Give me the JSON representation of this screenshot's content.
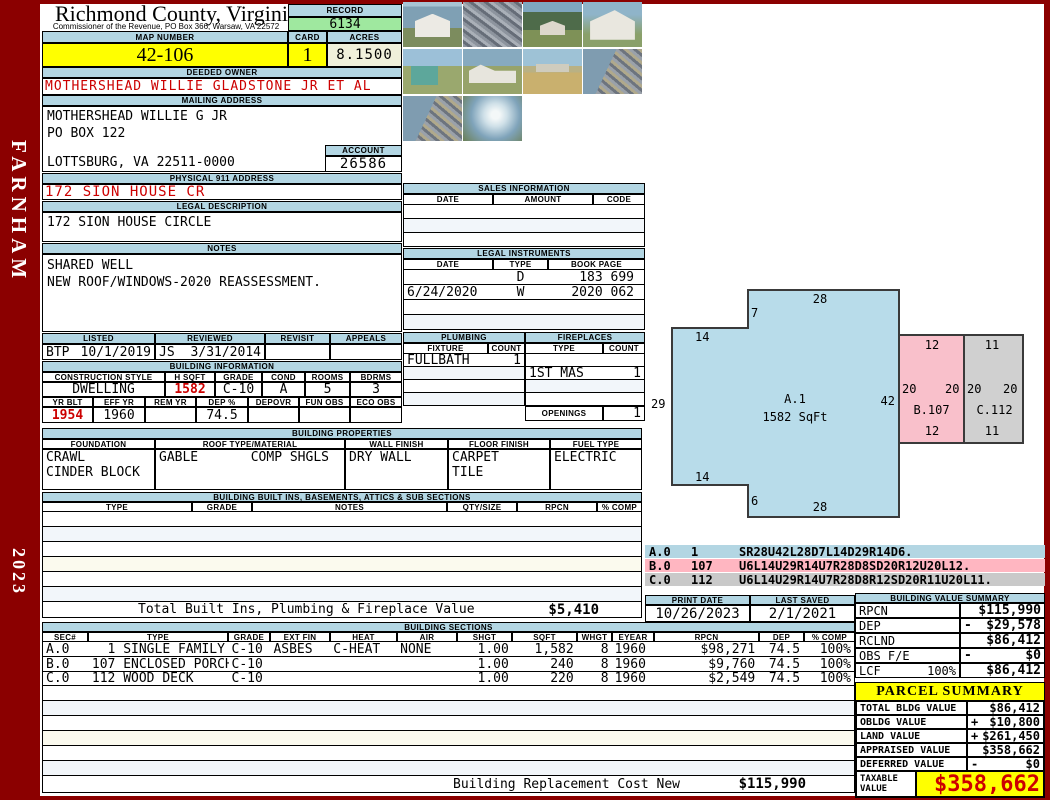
{
  "frame": {
    "district": "FARNHAM",
    "year": "2023"
  },
  "header": {
    "county": "Richmond County, Virginia",
    "subtitle": "Commissioner of the Revenue, PO Box 366, Warsaw, VA 22572",
    "record_label": "RECORD",
    "record": "6134",
    "map_number_label": "MAP NUMBER",
    "map_number": "42-106",
    "card_label": "CARD",
    "card": "1",
    "acres_label": "ACRES",
    "acres": "8.1500"
  },
  "owner": {
    "deeded_owner_label": "DEEDED OWNER",
    "deeded_owner": "MOTHERSHEAD WILLIE GLADSTONE JR ET AL",
    "mailing_address_label": "MAILING ADDRESS",
    "mailing_line1": "MOTHERSHEAD WILLIE G JR",
    "mailing_line2": "PO BOX 122",
    "mailing_line3": "LOTTSBURG, VA 22511-0000",
    "account_label": "ACCOUNT",
    "account": "26586",
    "physical_address_label": "PHYSICAL 911 ADDRESS",
    "physical_address": "172 SION HOUSE CR",
    "legal_description_label": "LEGAL DESCRIPTION",
    "legal_description": "172 SION HOUSE CIRCLE",
    "notes_label": "NOTES",
    "notes_line1": "SHARED WELL",
    "notes_line2": "NEW ROOF/WINDOWS-2020 REASSESSMENT."
  },
  "review": {
    "listed_label": "LISTED",
    "reviewed_label": "REVIEWED",
    "revisit_label": "REVISIT",
    "appeals_label": "APPEALS",
    "listed_by": "BTP",
    "listed_date": "10/1/2019",
    "reviewed_by": "JS",
    "reviewed_date": "3/31/2014",
    "revisit": "",
    "appeals": ""
  },
  "building_information": {
    "title": "BUILDING INFORMATION",
    "construction_style_label": "CONSTRUCTION STYLE",
    "construction_style": "DWELLING",
    "hsqft_label": "H SQFT",
    "hsqft": "1582",
    "grade_label": "GRADE",
    "grade": "C-10",
    "cond_label": "COND",
    "cond": "A",
    "rooms_label": "ROOMS",
    "rooms": "5",
    "bdrms_label": "BDRMS",
    "bdrms": "3",
    "yr_blt_label": "YR BLT",
    "yr_blt": "1954",
    "eff_yr_label": "EFF YR",
    "eff_yr": "1960",
    "rem_yr_label": "REM YR",
    "rem_yr": "",
    "dep_label": "DEP %",
    "dep": "74.5",
    "depovr_label": "DEPOVR",
    "depovr": "",
    "fun_obs_label": "FUN OBS",
    "fun_obs": "",
    "eco_obs_label": "ECO OBS",
    "eco_obs": ""
  },
  "building_properties": {
    "title": "BUILDING PROPERTIES",
    "foundation_label": "FOUNDATION",
    "foundation_line1": "CRAWL",
    "foundation_line2": "CINDER BLOCK",
    "roof_label": "ROOF TYPE/MATERIAL",
    "roof_type": "GABLE",
    "roof_material": "COMP SHGLS",
    "wall_label": "WALL FINISH",
    "wall_finish": "DRY WALL",
    "floor_label": "FLOOR FINISH",
    "floor_line1": "CARPET",
    "floor_line2": "TILE",
    "fuel_label": "FUEL TYPE",
    "fuel_type": "ELECTRIC"
  },
  "built_ins": {
    "title": "BUILDING BUILT INS, BASEMENTS, ATTICS & SUB SECTIONS",
    "headers": [
      "TYPE",
      "GRADE",
      "NOTES",
      "QTY/SIZE",
      "RPCN",
      "% COMP"
    ],
    "total_label": "Total Built Ins, Plumbing & Fireplace Value",
    "total_value": "$5,410"
  },
  "sales": {
    "title": "SALES INFORMATION",
    "headers": [
      "DATE",
      "AMOUNT",
      "CODE"
    ]
  },
  "legal_instruments": {
    "title": "LEGAL INSTRUMENTS",
    "headers": [
      "DATE",
      "TYPE",
      "BOOK PAGE"
    ],
    "rows": [
      [
        "",
        "D",
        "183 699"
      ],
      [
        "6/24/2020",
        "W",
        "2020 062"
      ],
      [
        "",
        "",
        ""
      ],
      [
        "",
        "",
        ""
      ]
    ]
  },
  "plumbing": {
    "title": "PLUMBING",
    "fixture_label": "FIXTURE",
    "count_label": "COUNT",
    "rows": [
      [
        "FULLBATH",
        "1"
      ],
      [
        "",
        ""
      ],
      [
        "",
        ""
      ],
      [
        "",
        ""
      ]
    ]
  },
  "fireplaces": {
    "title": "FIREPLACES",
    "type_label": "TYPE",
    "count_label": "COUNT",
    "rows": [
      [
        "",
        ""
      ],
      [
        "1ST MAS",
        "1"
      ],
      [
        "",
        ""
      ],
      [
        "",
        ""
      ]
    ],
    "openings_label": "OPENINGS",
    "openings": "1"
  },
  "sketch": {
    "a_name": "A.1",
    "a_sqft": "1582 SqFt",
    "b_name": "B.107",
    "c_name": "C.112",
    "dims": {
      "a_top": "28",
      "a_notch_top": "7",
      "a_ext_top": "14",
      "a_left": "29",
      "a_ext_bottom": "14",
      "a_notch_bottom": "6",
      "a_bottom": "28",
      "a_right": "42",
      "b_top": "12",
      "b_left": "20",
      "b_right": "20",
      "b_bottom": "12",
      "c_top": "11",
      "c_left": "20",
      "c_right": "20",
      "c_bottom": "11"
    },
    "codes": [
      {
        "sec": "A.0",
        "type": "1",
        "path": "SR28U42L28D7L14D29R14D6."
      },
      {
        "sec": "B.0",
        "type": "107",
        "path": "U6L14U29R14U7R28D8SD20R12U20L12."
      },
      {
        "sec": "C.0",
        "type": "112",
        "path": "U6L14U29R14U7R28D8R12SD20R11U20L11."
      }
    ]
  },
  "print_info": {
    "print_date_label": "PRINT DATE",
    "print_date": "10/26/2023",
    "last_saved_label": "LAST SAVED",
    "last_saved": "2/1/2021"
  },
  "building_value_summary": {
    "title": "BUILDING VALUE SUMMARY",
    "rows": [
      {
        "label": "RPCN",
        "extra": "",
        "sign": "",
        "value": "$115,990"
      },
      {
        "label": "DEP",
        "extra": "",
        "sign": "-",
        "value": "$29,578"
      },
      {
        "label": "RCLND",
        "extra": "",
        "sign": "",
        "value": "$86,412"
      },
      {
        "label": "OBS F/E",
        "extra": "",
        "sign": "-",
        "value": "$0"
      },
      {
        "label": "LCF",
        "extra": "100%",
        "sign": "",
        "value": "$86,412"
      }
    ]
  },
  "building_sections": {
    "title": "BUILDING SECTIONS",
    "headers": [
      "SEC#",
      "TYPE",
      "GRADE",
      "EXT FIN",
      "HEAT",
      "AIR",
      "SHGT",
      "SQFT",
      "WHGT",
      "EYEAR",
      "RPCN",
      "DEP",
      "% COMP"
    ],
    "rows": [
      [
        "A.0",
        "  1 SINGLE FAMILY",
        "C-10",
        "ASBES",
        "C-HEAT",
        "NONE",
        "1.00",
        "1,582",
        "8",
        "1960",
        "$98,271",
        "74.5",
        "100%"
      ],
      [
        "B.0",
        "107 ENCLOSED PORCH",
        "C-10",
        "",
        "",
        "",
        "1.00",
        "240",
        "8",
        "1960",
        "$9,760",
        "74.5",
        "100%"
      ],
      [
        "C.0",
        "112 WOOD DECK",
        "C-10",
        "",
        "",
        "",
        "1.00",
        "220",
        "8",
        "1960",
        "$2,549",
        "74.5",
        "100%"
      ]
    ]
  },
  "replacement": {
    "label": "Building Replacement Cost New",
    "value": "$115,990"
  },
  "parcel_summary": {
    "title": "PARCEL SUMMARY",
    "rows": [
      {
        "label": "TOTAL BLDG VALUE",
        "sign": "",
        "value": "$86,412"
      },
      {
        "label": "OBLDG VALUE",
        "sign": "+",
        "value": "$10,800"
      },
      {
        "label": "LAND VALUE",
        "sign": "+",
        "value": "$261,450"
      },
      {
        "label": "APPRAISED VALUE",
        "sign": "",
        "value": "$358,662"
      },
      {
        "label": "DEFERRED VALUE",
        "sign": "-",
        "value": "$0"
      }
    ],
    "taxable_label": "TAXABLE VALUE",
    "taxable_value": "$358,662"
  },
  "photos": [
    "white-garage",
    "riprap-pile",
    "house-with-trees",
    "white-building-gable",
    "teal-shed",
    "white-house-front",
    "field-and-house",
    "shoreline-riprap",
    "shoreline-riprap",
    "waterfront-dock"
  ],
  "colors": {
    "frame_red": "#8b0000",
    "header_bar": "#b3d6e3",
    "record_green": "#9fe89f",
    "highlight_yellow": "#ffff00",
    "acres_cream": "#f0f0da",
    "accent_red": "#cc0000",
    "sketch_a": "#b8dcea",
    "sketch_b": "#f9c0cb",
    "sketch_c": "#d0d0d0"
  }
}
